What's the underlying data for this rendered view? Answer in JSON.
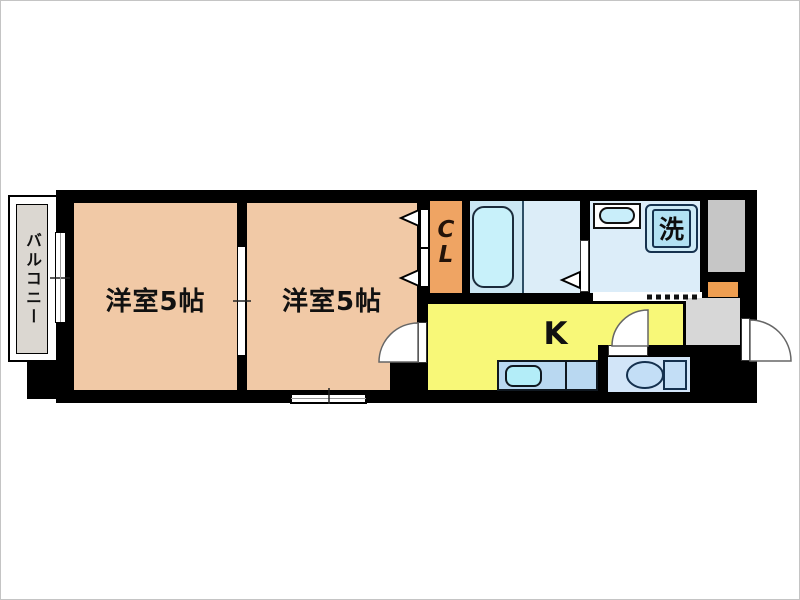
{
  "floorplan": {
    "kind": "apartment-floor-plan",
    "balcony": {
      "label": "バルコニー"
    },
    "room1": {
      "label": "洋室5帖"
    },
    "room2": {
      "label": "洋室5帖"
    },
    "closet": {
      "letter_top": "C",
      "letter_bottom": "L"
    },
    "kitchen": {
      "label": "K"
    },
    "laundry": {
      "label": "洗"
    },
    "colors": {
      "wall": "#000000",
      "room": "#f1c9a6",
      "closet": "#efa463",
      "kitchen": "#f8f878",
      "bath_floor": "#cbe7f3",
      "bathtub": "#c8f1fa",
      "washroom": "#dcedf9",
      "washer_pan": "#b2e1f3",
      "toilet_room": "#d2e5f8",
      "fixture_blue": "#c3def6",
      "counter": "#b9d8f1",
      "counter_sink": "#b3edf8",
      "entrance_gray": "#d7d7d7",
      "shaft_gray": "#c6c6c6",
      "balcony_gray": "#dbd7d1",
      "accent_orange": "#ee9e51"
    }
  }
}
